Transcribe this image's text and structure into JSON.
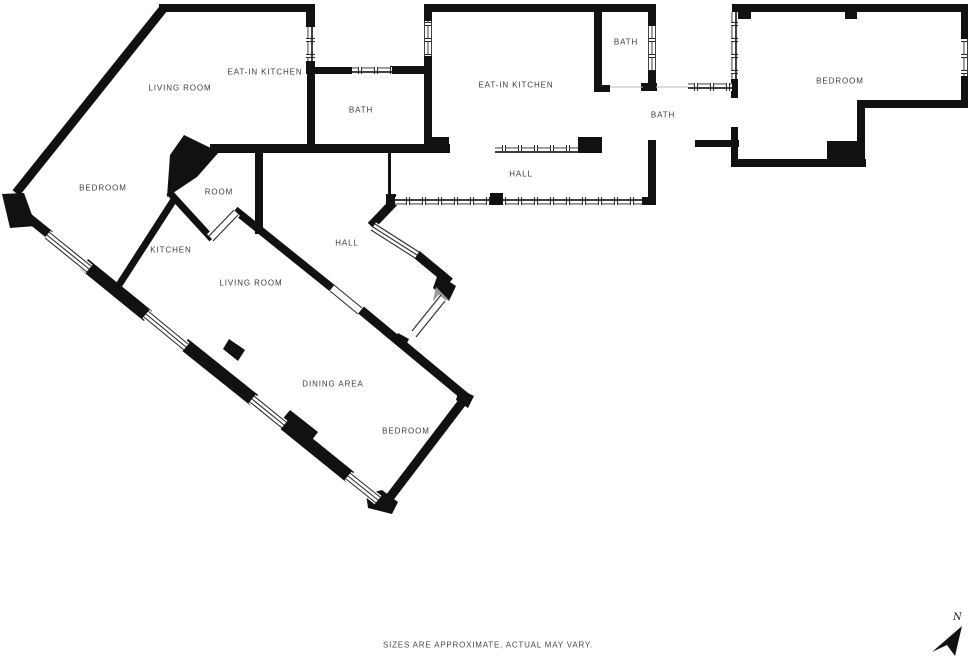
{
  "floor_plan": {
    "rooms": [
      {
        "id": "living-room-upper",
        "label": "LIVING ROOM"
      },
      {
        "id": "eat-in-kitchen-upper",
        "label": "EAT-IN KITCHEN"
      },
      {
        "id": "bath-upper-left",
        "label": "BATH"
      },
      {
        "id": "eat-in-kitchen-middle",
        "label": "EAT-IN KITCHEN"
      },
      {
        "id": "bath-top-middle",
        "label": "BATH"
      },
      {
        "id": "bath-right",
        "label": "BATH"
      },
      {
        "id": "bedroom-right",
        "label": "BEDROOM"
      },
      {
        "id": "hall-main",
        "label": "HALL"
      },
      {
        "id": "bedroom-left",
        "label": "BEDROOM"
      },
      {
        "id": "room-small",
        "label": "ROOM"
      },
      {
        "id": "kitchen",
        "label": "KITCHEN"
      },
      {
        "id": "hall-lower",
        "label": "HALL"
      },
      {
        "id": "living-room-lower",
        "label": "LIVING ROOM"
      },
      {
        "id": "dining-area",
        "label": "DINING AREA"
      },
      {
        "id": "bedroom-lower",
        "label": "BEDROOM"
      }
    ],
    "disclaimer": "SIZES ARE APPROXIMATE, ACTUAL MAY VARY.",
    "compass": {
      "label": "N"
    },
    "colors": {
      "wall": "#111111",
      "label_text": "#3d3d3d",
      "disclaimer_text": "#4a4a4a"
    }
  }
}
